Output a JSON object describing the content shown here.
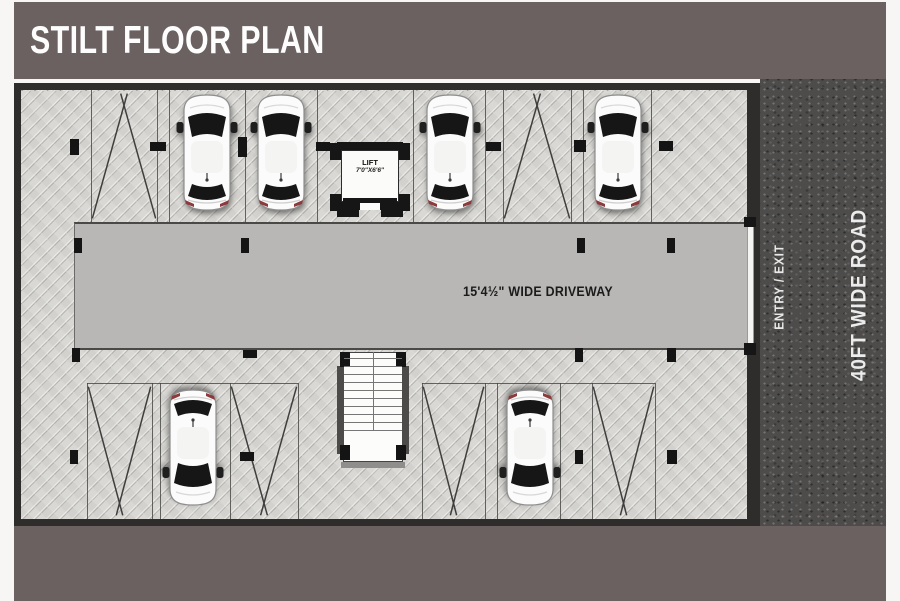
{
  "header": {
    "title": "STILT FLOOR PLAN"
  },
  "plan": {
    "lift": {
      "label": "LIFT",
      "size": "7'0\"X6'6\""
    },
    "driveway": {
      "label": "15'4½\" WIDE DRIVEWAY"
    }
  },
  "road": {
    "entry_exit_label": "ENTRY / EXIT",
    "road_label": "40FT WIDE ROAD"
  },
  "colors": {
    "header_bar": "#6a6160",
    "road_surface": "#4d4c4b",
    "paver_surface": "#d7d6d2",
    "driveway_surface": "#b8b7b5",
    "plan_border": "#2e2d2c",
    "marking_line": "#3f3e3d",
    "text_on_plan": "#1b1b1b",
    "text_on_road": "#ececec"
  }
}
